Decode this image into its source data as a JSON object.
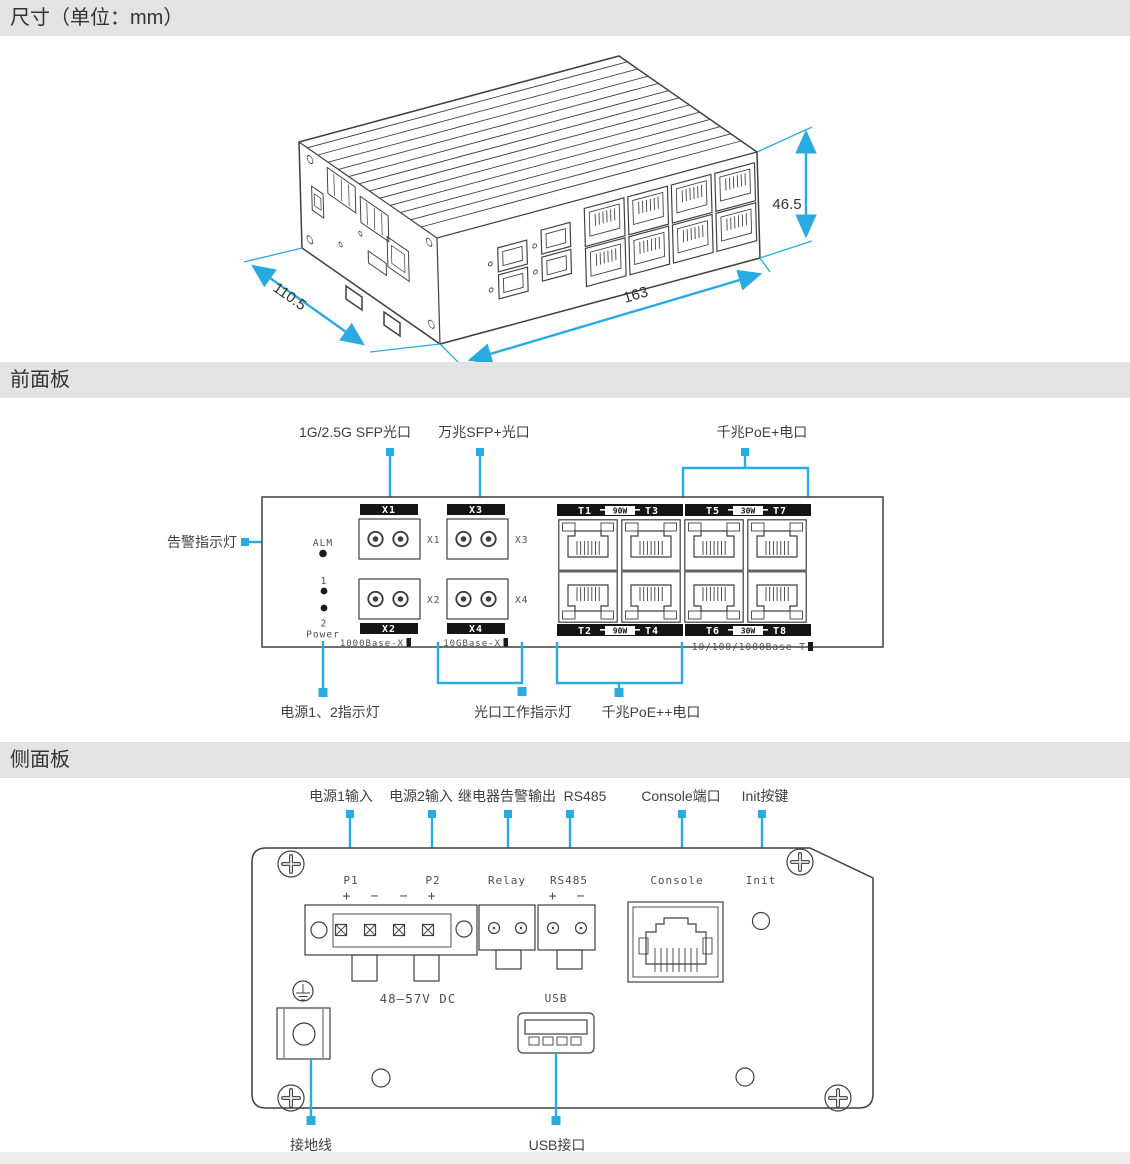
{
  "colors": {
    "accent": "#29abe2",
    "header_bg": "#e3e3e3",
    "ink": "#3f3f3f",
    "bar_bg": "#141414"
  },
  "headers": {
    "dimensions": "尺寸（单位：mm）",
    "front_panel": "前面板",
    "side_panel": "侧面板"
  },
  "iso": {
    "height_mm": "46.5",
    "depth_mm": "110.5",
    "width_mm": "163"
  },
  "front": {
    "callout_sfp_1g": "1G/2.5G SFP光口",
    "callout_sfp_10g": "万兆SFP+光口",
    "callout_poe_plus": "千兆PoE+电口",
    "callout_alarm": "告警指示灯",
    "callout_power_led": "电源1、2指示灯",
    "callout_optical_led": "光口工作指示灯",
    "callout_poe_pp": "千兆PoE++电口",
    "alm": "ALM",
    "led1": "1",
    "led2": "2",
    "power": "Power",
    "x1": "X1",
    "x2": "X2",
    "x3": "X3",
    "x4": "X4",
    "std_1g": "1000Base-X",
    "std_10g": "10GBase-X",
    "std_t": "10/100/1000Base-T",
    "bar_tl": {
      "a": "T1",
      "w": "90W",
      "b": "T3"
    },
    "bar_tr": {
      "a": "T5",
      "w": "30W",
      "b": "T7"
    },
    "bar_bl": {
      "a": "T2",
      "w": "90W",
      "b": "T4"
    },
    "bar_br": {
      "a": "T6",
      "w": "30W",
      "b": "T8"
    }
  },
  "side": {
    "callout_p1": "电源1输入",
    "callout_p2": "电源2输入",
    "callout_relay": "继电器告警输出",
    "callout_rs485": "RS485",
    "callout_console": "Console端口",
    "callout_init": "Init按键",
    "callout_ground": "接地线",
    "callout_usb": "USB接口",
    "p1": "P1",
    "p2": "P2",
    "plus": "+",
    "minus": "−",
    "relay": "Relay",
    "rs485": "RS485",
    "console": "Console",
    "init": "Init",
    "voltage": "48–57V DC",
    "usb": "USB"
  }
}
